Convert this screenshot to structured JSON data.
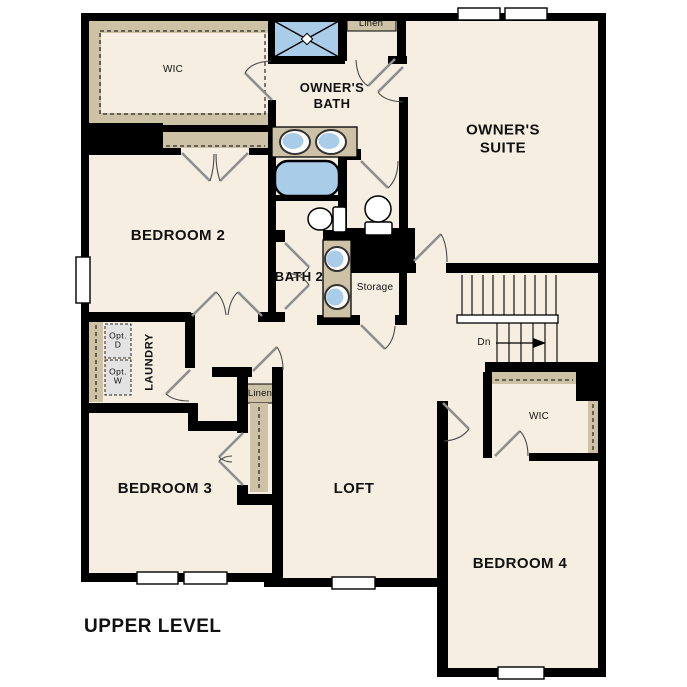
{
  "colors": {
    "background": "#ffffff",
    "floor": "#f5eee1",
    "wall": "#000000",
    "closet": "#cdc1a6",
    "fixture": "#a9cce9",
    "door_swing": "#8f8f8f",
    "opt_box": "#e3e3e3"
  },
  "rooms": {
    "wic_main": {
      "label": "WIC"
    },
    "owners_bath": {
      "label": "OWNER'S\nBATH"
    },
    "owners_suite": {
      "label": "OWNER'S\nSUITE"
    },
    "bedroom2": {
      "label": "BEDROOM 2"
    },
    "bath2": {
      "label": "BATH 2"
    },
    "storage": {
      "label": "Storage"
    },
    "laundry": {
      "label": "LAUNDRY"
    },
    "linen_top": {
      "label": "Linen"
    },
    "linen_hall": {
      "label": "Linen"
    },
    "bedroom3": {
      "label": "BEDROOM 3"
    },
    "loft": {
      "label": "LOFT"
    },
    "wic_bedroom4": {
      "label": "WIC"
    },
    "bedroom4": {
      "label": "BEDROOM 4"
    }
  },
  "annotations": {
    "stairs_down": {
      "label": "Dn"
    },
    "opt_dryer": {
      "label": "Opt.\nD"
    },
    "opt_washer": {
      "label": "Opt.\nW"
    },
    "plan_title": {
      "label": "UPPER LEVEL"
    }
  }
}
